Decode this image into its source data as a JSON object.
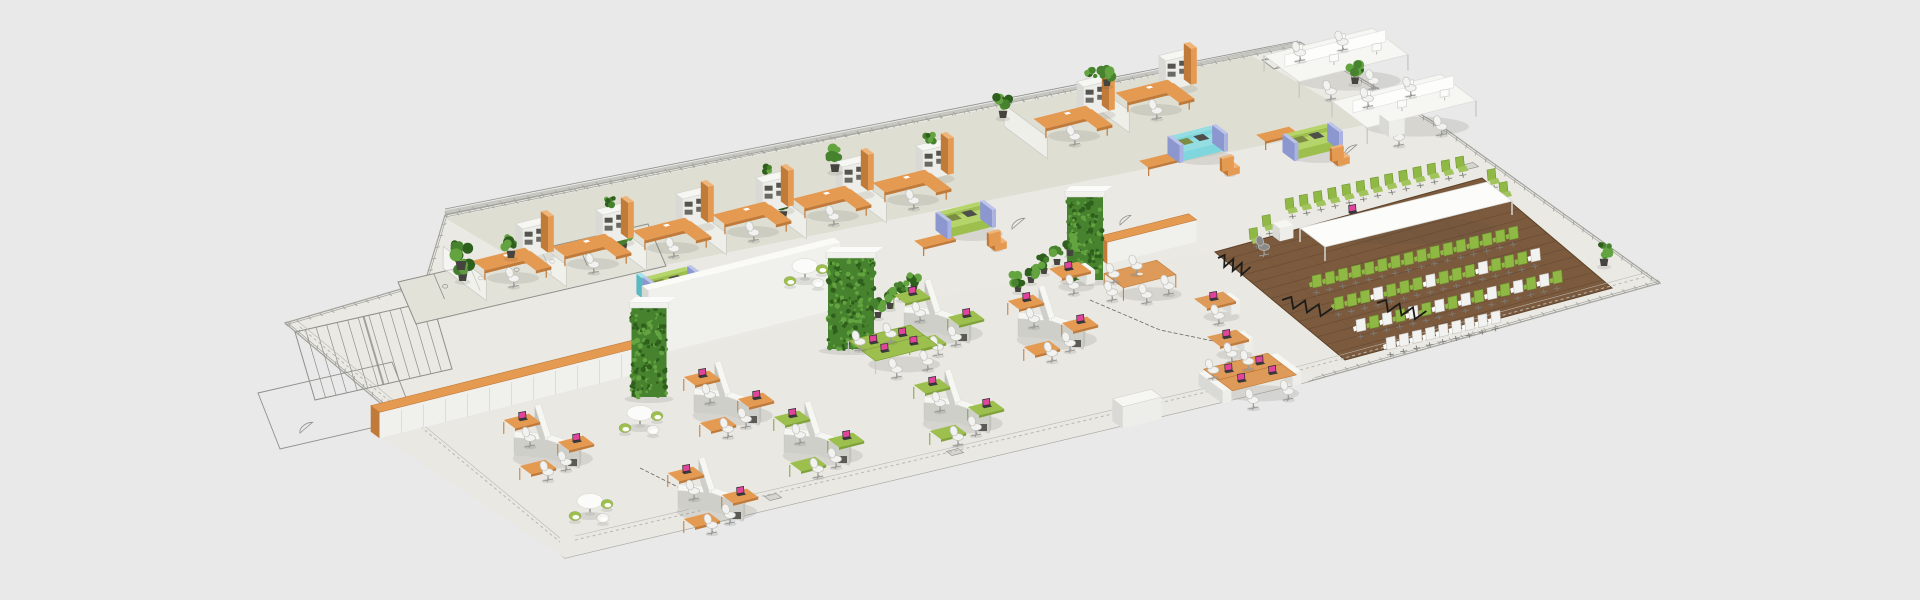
{
  "scene": {
    "canvas": {
      "width": 1920,
      "height": 600,
      "background": "#e8e9e8"
    },
    "palette": {
      "plate": "#eae9e4",
      "plate_stroke": "#a3a39e",
      "office_floor": "#dfded3",
      "open_floor": "#e9e8e2",
      "wood": "#7b5a3e",
      "wood_dark": "#644730",
      "wood_stroke": "#5d4228",
      "line": "#8f8f8b",
      "line_light": "#b8b8b2",
      "hatch": "#a0a09b",
      "white": "#f6f6f3",
      "white_front": "#ededea",
      "white_side": "#d9d9d5",
      "white_stroke": "#d2d2cd",
      "orange": "#e59a52",
      "orange_light": "#f0b478",
      "orange_dark": "#c07a3a",
      "green": "#9dbf4d",
      "green_dark": "#7fa239",
      "green_chair": "#8fb944",
      "green_chair_dark": "#6f9430",
      "leafy": "#47822e",
      "leafy_dark": "#2f5f1d",
      "leafy_light": "#63a441",
      "teal": "#7fd6dd",
      "teal_dark": "#58b9c2",
      "peri": "#a9b2e2",
      "peri_dark": "#8d97cf",
      "olive": "#7d8c43",
      "pot": "#45443f",
      "metal": "#9a9a98",
      "dark": "#2e2e30",
      "screen_pink": "#e0449c",
      "chair_white": "#f2f2f0",
      "chair_stroke": "#c2c2bd",
      "shadow": "rgba(70,70,64,0.12)"
    },
    "outline": {
      "silhouette": [
        [
          285,
          323
        ],
        [
          425,
          282
        ],
        [
          445,
          215
        ],
        [
          1300,
          42
        ],
        [
          1447,
          130
        ],
        [
          1660,
          283
        ],
        [
          1307,
          382
        ],
        [
          565,
          558
        ]
      ],
      "inner_borders": [
        {
          "from": [
            575,
            548
          ],
          "to": [
            1300,
            378
          ]
        },
        {
          "from": [
            1300,
            378
          ],
          "to": [
            1648,
            284
          ]
        },
        {
          "from": [
            300,
            335
          ],
          "to": [
            560,
            550
          ]
        }
      ]
    },
    "floors": {
      "office_quad": [
        [
          445,
          218
        ],
        [
          1252,
          56
        ],
        [
          1370,
          124
        ],
        [
          560,
          286
        ]
      ],
      "open_quad": [
        [
          372,
          430
        ],
        [
          840,
          312
        ],
        [
          1215,
          252
        ],
        [
          1345,
          360
        ],
        [
          1307,
          382
        ],
        [
          565,
          558
        ]
      ],
      "wood_quad": [
        [
          1215,
          252
        ],
        [
          1482,
          178
        ],
        [
          1612,
          288
        ],
        [
          1345,
          360
        ]
      ],
      "plank_count": 14
    },
    "line_art": {
      "stairs": {
        "quad": [
          [
            295,
            332
          ],
          [
            432,
            301
          ],
          [
            452,
            369
          ],
          [
            315,
            400
          ]
        ],
        "treads": 13
      },
      "bath": {
        "quad": [
          [
            398,
            282
          ],
          [
            648,
            224
          ],
          [
            666,
            266
          ],
          [
            416,
            324
          ]
        ],
        "stalls": 7
      },
      "rooms": [
        [
          [
            258,
            393
          ],
          [
            392,
            362
          ],
          [
            414,
            418
          ],
          [
            280,
            449
          ]
        ]
      ],
      "xboxes": [
        [
          [
            703,
            291
          ],
          [
            798,
            268
          ],
          [
            818,
            283
          ],
          [
            723,
            306
          ]
        ],
        [
          [
            1262,
            60
          ],
          [
            1310,
            48
          ],
          [
            1322,
            57
          ],
          [
            1274,
            69
          ]
        ]
      ],
      "arcs": [
        {
          "x": 695,
          "y": 298,
          "r": 16
        },
        {
          "x": 853,
          "y": 262,
          "r": 15
        },
        {
          "x": 1012,
          "y": 226,
          "r": 14
        },
        {
          "x": 1345,
          "y": 152,
          "r": 13
        },
        {
          "x": 300,
          "y": 430,
          "r": 14
        },
        {
          "x": 1120,
          "y": 222,
          "r": 12
        }
      ],
      "floor_boxes": [
        [
          1470,
          166
        ],
        [
          773,
          497
        ],
        [
          955,
          452
        ],
        [
          1125,
          412
        ]
      ],
      "back_wall": {
        "from": [
          445,
          212
        ],
        "to": [
          1298,
          44
        ]
      },
      "cables": [
        [
          [
            1090,
            300
          ],
          [
            1160,
            330
          ],
          [
            1218,
            342
          ]
        ],
        [
          [
            640,
            468
          ],
          [
            700,
            498
          ]
        ]
      ]
    },
    "walls": {
      "cabinet_row_a": {
        "c": [
          507,
          402
        ],
        "w": 272,
        "d": 11,
        "h": 26
      },
      "cabinet_row_b": {
        "c": [
          1148,
          250
        ],
        "w": 92,
        "d": 10,
        "h": 22
      },
      "white_wall": {
        "c": [
          741,
          330
        ],
        "w": 198,
        "d": 8,
        "h": 66
      },
      "pillars": [
        {
          "x": 649,
          "base": 397,
          "w": 35,
          "h": 90
        },
        {
          "x": 851,
          "base": 349,
          "w": 46,
          "h": 92
        },
        {
          "x": 1085,
          "base": 280,
          "w": 36,
          "h": 84
        }
      ]
    },
    "office": {
      "bays": [
        {
          "x": 505,
          "y": 272,
          "tall_plant": true
        },
        {
          "x": 585,
          "y": 258,
          "shelf_plant": true
        },
        {
          "x": 665,
          "y": 242,
          "tall_plant": true
        },
        {
          "x": 745,
          "y": 226,
          "shelf_plant": true
        },
        {
          "x": 825,
          "y": 210,
          "tall_plant": true
        },
        {
          "x": 905,
          "y": 194,
          "shelf_plant": true
        },
        {
          "x": 1066,
          "y": 130,
          "shelf_plant": true
        },
        {
          "x": 1148,
          "y": 104
        }
      ]
    },
    "lounges": [
      {
        "type": "green",
        "x": 1312,
        "y": 150,
        "bench": [
          1277,
          144
        ],
        "chair": [
          1340,
          162
        ]
      },
      {
        "type": "teal",
        "x": 1197,
        "y": 152,
        "bench": [
          1160,
          170
        ],
        "chair": [
          1230,
          172
        ]
      },
      {
        "type": "green",
        "x": 965,
        "y": 228,
        "bench": [
          935,
          250
        ],
        "chair": [
          997,
          247
        ]
      },
      {
        "type": "green",
        "x": 672,
        "y": 293,
        "teal_panel": true,
        "chair": [
          692,
          314
        ],
        "table": [
          712,
          300
        ]
      }
    ],
    "bench_desks": [
      {
        "c": [
          1336,
          71
        ]
      },
      {
        "c": [
          1404,
          117
        ]
      }
    ],
    "drawer_box": {
      "c": [
        1392,
        132
      ],
      "w": 16,
      "d": 12,
      "h": 16
    },
    "open_plan": {
      "hex": [
        {
          "c": [
            938,
            330
          ],
          "accent": "green"
        },
        {
          "c": [
            1052,
            336
          ],
          "accent": "orange"
        },
        {
          "c": [
            728,
            412
          ],
          "accent": "orange"
        },
        {
          "c": [
            958,
            420
          ],
          "accent": "green"
        },
        {
          "c": [
            818,
            452
          ],
          "accent": "green"
        },
        {
          "c": [
            548,
            455
          ],
          "accent": "orange"
        },
        {
          "c": [
            712,
            508
          ],
          "accent": "orange"
        }
      ],
      "green_bench": {
        "c": [
          893,
          356
        ]
      },
      "meeting_table": {
        "c": [
          1140,
          287
        ],
        "chairs": 5
      },
      "mini_desk": {
        "c": [
          1070,
          282
        ]
      },
      "wooden_singles": [
        [
          1215,
          312
        ],
        [
          1228,
          350
        ]
      ],
      "wooden_bench": {
        "c": [
          1250,
          385
        ]
      },
      "white_cabinet": {
        "c": [
          1137,
          420
        ],
        "w": 40,
        "d": 13,
        "h": 22
      },
      "round_tables": [
        [
          805,
          278
        ],
        [
          640,
          425
        ],
        [
          590,
          513
        ]
      ],
      "pot_rows": [
        [
          [
            1018,
            292
          ],
          [
            1031,
            283
          ],
          [
            1044,
            274
          ],
          [
            1057,
            265
          ],
          [
            1070,
            256
          ]
        ],
        [
          [
            878,
            318
          ],
          [
            890,
            309
          ],
          [
            902,
            300
          ],
          [
            914,
            291
          ]
        ]
      ]
    },
    "conference": {
      "table": {
        "quad": [
          [
            1300,
            228
          ],
          [
            1487,
            182
          ],
          [
            1512,
            201
          ],
          [
            1325,
            247
          ]
        ],
        "laptop": [
          1352,
          212
        ]
      },
      "back_row": {
        "start": [
          1292,
          212
        ],
        "step": [
          14.2,
          -3.45
        ],
        "n": 13
      },
      "end_chairs": [
        [
          1269,
          229
        ],
        [
          1256,
          242
        ],
        [
          1494,
          183
        ],
        [
          1506,
          196
        ]
      ],
      "audience": [
        {
          "start": [
            1316,
            288
          ],
          "step": [
            13.1,
            -3.2
          ],
          "n": 16,
          "pattern": "green"
        },
        {
          "start": [
            1338,
            310
          ],
          "step": [
            13.1,
            -3.2
          ],
          "n": 16,
          "pattern": "mostly-green"
        },
        {
          "start": [
            1360,
            332
          ],
          "step": [
            13.1,
            -3.2
          ],
          "n": 16,
          "pattern": "alternate"
        },
        {
          "start": [
            1390,
            350
          ],
          "step": [
            13.1,
            -3.2
          ],
          "n": 9,
          "pattern": "white"
        }
      ],
      "zigzags": [
        {
          "from": [
            1282,
            300
          ],
          "to": [
            1330,
            313
          ]
        },
        {
          "from": [
            1377,
            303
          ],
          "to": [
            1424,
            316
          ]
        },
        {
          "from": [
            1218,
            258
          ],
          "to": [
            1248,
            272
          ]
        }
      ],
      "lectern": [
        1283,
        237
      ],
      "lectern_chair": [
        1264,
        252
      ]
    },
    "plants": [
      {
        "x": 461,
        "y": 270,
        "s": 1.5
      },
      {
        "x": 511,
        "y": 258,
        "s": 1.2
      },
      {
        "x": 835,
        "y": 172,
        "s": 1.3
      },
      {
        "x": 1003,
        "y": 118,
        "s": 1.2
      },
      {
        "x": 1107,
        "y": 86,
        "s": 1.1
      },
      {
        "x": 1355,
        "y": 84,
        "s": 1.1
      },
      {
        "x": 1604,
        "y": 266,
        "s": 1.2
      }
    ]
  }
}
